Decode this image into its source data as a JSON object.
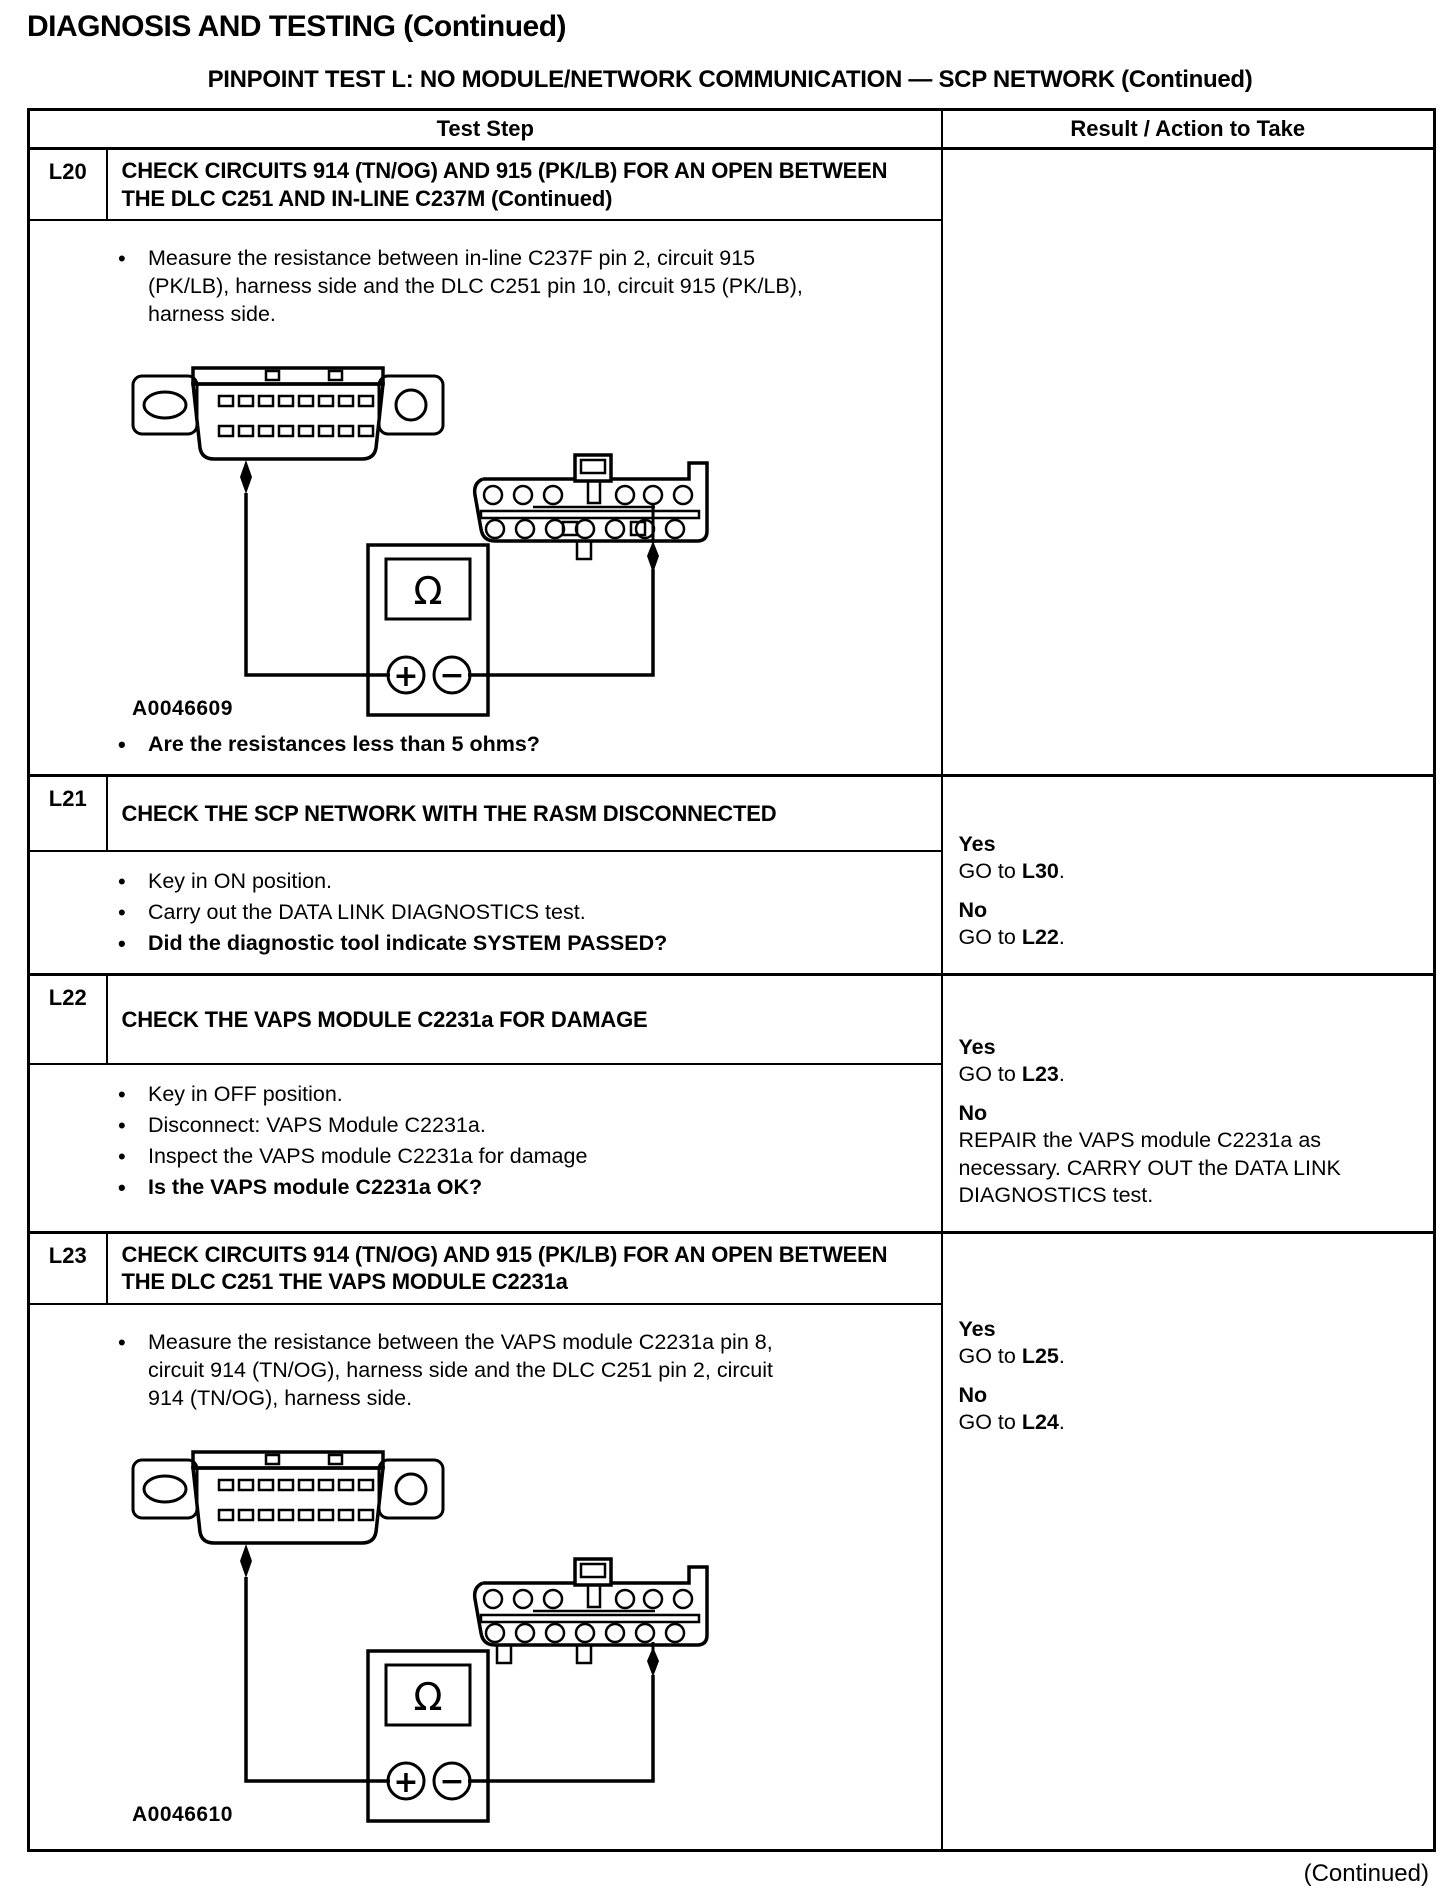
{
  "page": {
    "heading": "DIAGNOSIS AND TESTING (Continued)",
    "subtitle": "PINPOINT TEST  L: NO MODULE/NETWORK COMMUNICATION — SCP NETWORK (Continued)",
    "continued_footer": "(Continued)"
  },
  "table": {
    "headers": {
      "test_step": "Test Step",
      "result": "Result / Action to Take"
    },
    "rows": [
      {
        "id": "L20",
        "title": "CHECK CIRCUITS 914 (TN/OG) AND 915 (PK/LB) FOR AN OPEN BETWEEN THE DLC C251 AND IN-LINE C237M (Continued)",
        "bullets": [
          {
            "text": "Measure the resistance between in-line C237F pin 2, circuit 915 (PK/LB), harness side and the DLC C251 pin 10, circuit 915 (PK/LB), harness side."
          }
        ],
        "figure": {
          "label": "A0046609",
          "meter_symbol": "Ω",
          "plus_terminal": "+",
          "minus_terminal": "−"
        },
        "question": {
          "text": "Are the resistances less than 5 ohms?"
        },
        "results": []
      },
      {
        "id": "L21",
        "title": "CHECK THE SCP NETWORK WITH THE RASM DISCONNECTED",
        "bullets": [
          {
            "text": "Key in ON position."
          },
          {
            "text": "Carry out the DATA LINK DIAGNOSTICS test."
          },
          {
            "text": "Did the diagnostic tool indicate SYSTEM PASSED?"
          }
        ],
        "results": [
          {
            "label": "Yes",
            "action_prefix": "GO to ",
            "action_target": "L30",
            "action_suffix": "."
          },
          {
            "label": "No",
            "action_prefix": "GO to ",
            "action_target": "L22",
            "action_suffix": "."
          }
        ]
      },
      {
        "id": "L22",
        "title": "CHECK THE VAPS MODULE C2231a FOR DAMAGE",
        "bullets": [
          {
            "text": "Key in OFF position."
          },
          {
            "text": "Disconnect: VAPS Module C2231a."
          },
          {
            "text": "Inspect the VAPS module C2231a for damage"
          },
          {
            "text": "Is the VAPS module C2231a OK?"
          }
        ],
        "results": [
          {
            "label": "Yes",
            "action_prefix": "GO to ",
            "action_target": "L23",
            "action_suffix": "."
          },
          {
            "label": "No",
            "action_text": "REPAIR the VAPS module C2231a as necessary. CARRY OUT the DATA LINK DIAGNOSTICS test."
          }
        ]
      },
      {
        "id": "L23",
        "title": "CHECK CIRCUITS 914 (TN/OG) AND 915 (PK/LB) FOR AN OPEN BETWEEN THE DLC C251 THE VAPS MODULE C2231a",
        "bullets": [
          {
            "text": "Measure the resistance between the VAPS module C2231a pin 8, circuit 914 (TN/OG), harness side and the DLC C251 pin 2, circuit 914 (TN/OG), harness side."
          }
        ],
        "figure": {
          "label": "A0046610",
          "meter_symbol": "Ω",
          "plus_terminal": "+",
          "minus_terminal": "−"
        },
        "results": [
          {
            "label": "Yes",
            "action_prefix": "GO to ",
            "action_target": "L25",
            "action_suffix": "."
          },
          {
            "label": "No",
            "action_prefix": "GO to ",
            "action_target": "L24",
            "action_suffix": "."
          }
        ]
      }
    ]
  }
}
